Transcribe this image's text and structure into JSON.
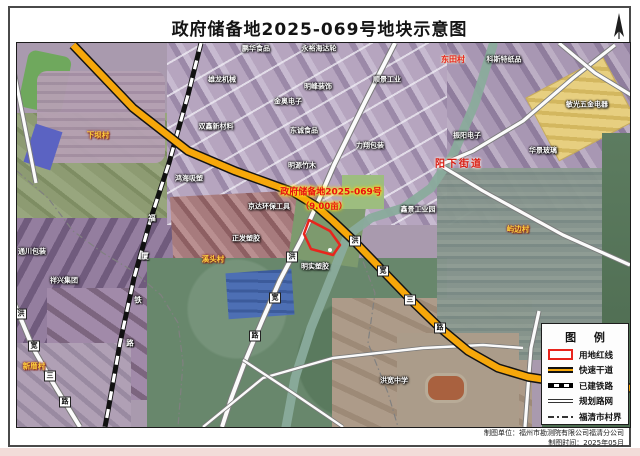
{
  "page": {
    "title": "政府储备地2025-069号地块示意图",
    "compass_icon": "north-arrow-icon"
  },
  "plot": {
    "name_line": "政府储备地2025-069号",
    "area_line": "（9.00亩）"
  },
  "map_labels": [
    {
      "t": "factory",
      "s": "鹏华食品",
      "x": 253,
      "y": 46
    },
    {
      "t": "factory",
      "s": "永裕海达轮",
      "x": 316,
      "y": 46
    },
    {
      "t": "factory",
      "s": "雄龙机械",
      "x": 219,
      "y": 77
    },
    {
      "t": "factory",
      "s": "明峰装饰",
      "x": 315,
      "y": 84
    },
    {
      "t": "factory",
      "s": "顺景工业",
      "x": 384,
      "y": 77
    },
    {
      "t": "factory",
      "s": "金奥电子",
      "x": 285,
      "y": 99
    },
    {
      "t": "factory",
      "s": "双鑫新材料",
      "x": 213,
      "y": 124
    },
    {
      "t": "factory",
      "s": "东诚食品",
      "x": 301,
      "y": 128
    },
    {
      "t": "factory",
      "s": "力翔包装",
      "x": 367,
      "y": 143
    },
    {
      "t": "factory",
      "s": "明源竹木",
      "x": 299,
      "y": 163
    },
    {
      "t": "factory",
      "s": "鸿海吸塑",
      "x": 186,
      "y": 176
    },
    {
      "t": "factory",
      "s": "京达环保工具",
      "x": 266,
      "y": 204
    },
    {
      "t": "factory",
      "s": "正发塑胶",
      "x": 243,
      "y": 236
    },
    {
      "t": "factory",
      "s": "明实塑胶",
      "x": 312,
      "y": 264
    },
    {
      "t": "factory",
      "s": "科斯特纸品",
      "x": 501,
      "y": 57
    },
    {
      "t": "factory",
      "s": "敏光五金电器",
      "x": 584,
      "y": 102
    },
    {
      "t": "factory",
      "s": "振阳电子",
      "x": 464,
      "y": 133
    },
    {
      "t": "factory",
      "s": "华景玻璃",
      "x": 540,
      "y": 148
    },
    {
      "t": "factory",
      "s": "通川包装",
      "x": 29,
      "y": 249
    },
    {
      "t": "factory",
      "s": "祥兴集团",
      "x": 61,
      "y": 278
    },
    {
      "t": "factory",
      "s": "鑫景工业园",
      "x": 415,
      "y": 207
    },
    {
      "t": "factory",
      "s": "洪宽中学",
      "x": 391,
      "y": 378
    },
    {
      "t": "village",
      "s": "下坝村",
      "x": 95,
      "y": 132
    },
    {
      "t": "village",
      "s": "溪头村",
      "x": 210,
      "y": 256
    },
    {
      "t": "village",
      "s": "屿边村",
      "x": 515,
      "y": 226
    },
    {
      "t": "village",
      "s": "新厝村",
      "x": 31,
      "y": 363
    },
    {
      "t": "district",
      "s": "东田村",
      "x": 450,
      "y": 57
    },
    {
      "t": "district-big",
      "s": "阳下街道",
      "x": 456,
      "y": 162
    },
    {
      "t": "roadbox",
      "s": "洪",
      "x": 352,
      "y": 238
    },
    {
      "t": "roadbox",
      "s": "宽",
      "x": 380,
      "y": 268
    },
    {
      "t": "roadbox",
      "s": "三",
      "x": 407,
      "y": 297
    },
    {
      "t": "roadbox",
      "s": "路",
      "x": 437,
      "y": 325
    },
    {
      "t": "roadbox",
      "s": "洪",
      "x": 289,
      "y": 254
    },
    {
      "t": "roadbox",
      "s": "宽",
      "x": 272,
      "y": 295
    },
    {
      "t": "roadbox",
      "s": "路",
      "x": 252,
      "y": 333
    },
    {
      "t": "roadbox",
      "s": "洪",
      "x": 18,
      "y": 311
    },
    {
      "t": "roadbox",
      "s": "宽",
      "x": 31,
      "y": 343
    },
    {
      "t": "roadbox",
      "s": "三",
      "x": 47,
      "y": 373
    },
    {
      "t": "roadbox",
      "s": "路",
      "x": 62,
      "y": 399
    },
    {
      "t": "railchar",
      "s": "福",
      "x": 149,
      "y": 215
    },
    {
      "t": "railchar",
      "s": "厦",
      "x": 142,
      "y": 253
    },
    {
      "t": "railchar",
      "s": "铁",
      "x": 135,
      "y": 297
    },
    {
      "t": "railchar",
      "s": "路",
      "x": 127,
      "y": 340
    },
    {
      "t": "plot1",
      "s": "政府储备地2025-069号",
      "x": 328,
      "y": 190
    },
    {
      "t": "plot2",
      "s": "（9.00亩）",
      "x": 321,
      "y": 204
    }
  ],
  "legend": {
    "title": "图 例",
    "items": [
      {
        "symbol": "redline",
        "label": "用地红线"
      },
      {
        "symbol": "expressway",
        "label": "快速干道"
      },
      {
        "symbol": "railway",
        "label": "已建铁路"
      },
      {
        "symbol": "planned",
        "label": "规划路网"
      },
      {
        "symbol": "boundary",
        "label": "福清市村界"
      }
    ]
  },
  "footer": {
    "line1": "制图单位：福州市勘测院有限公司福清分公司",
    "line2": "制图时间：2025年05月"
  },
  "colors": {
    "expressway": "#f6a70a",
    "plot_redline": "#e8251d",
    "river": "#8aab9c"
  }
}
